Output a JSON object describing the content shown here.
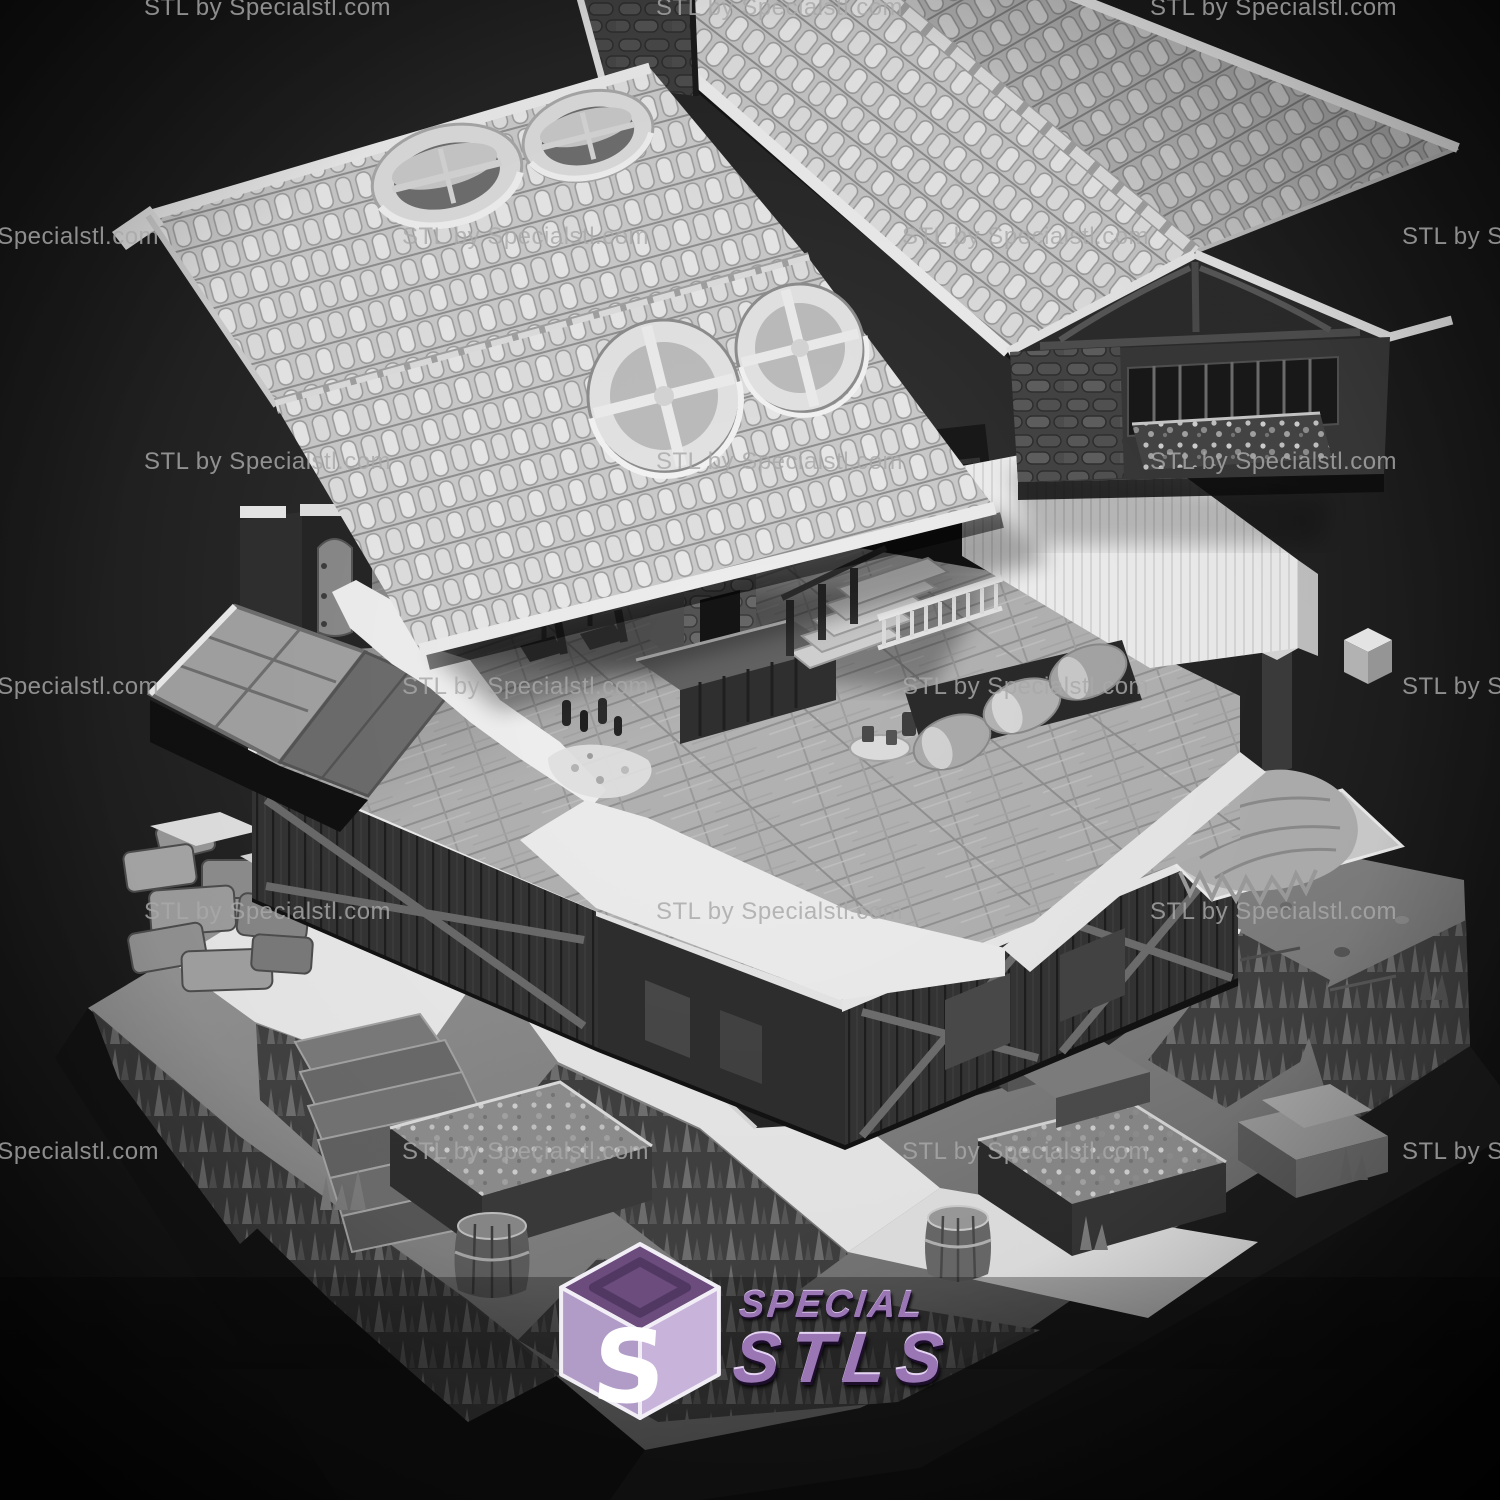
{
  "watermark": {
    "text": "STL by Specialstl.com"
  },
  "logo": {
    "monogram": "S",
    "brand_top": "SPECIAL",
    "brand_bottom": "STLS",
    "colors": {
      "cube_top": "#6b4c7d",
      "cube_left": "#b19bc7",
      "cube_right": "#c8b4da",
      "text_purple": "#9a76b5",
      "edge_white": "#f2eef6"
    }
  },
  "scene": {
    "subject": "Exploded-view monochrome 3D render of a two-story fantasy tavern terrain kit",
    "style": "grayscale clay render on dark vignette background",
    "layers": [
      {
        "name": "roof-assembly",
        "features": [
          "barrel-tile roof slopes",
          "two oval roof vents",
          "two round cross-pane windows",
          "half-timbered gable with window band and flower box",
          "stone dormer face"
        ]
      },
      {
        "name": "upper-floor",
        "features": [
          "wood plank floor",
          "table with chairs and bottles",
          "standing barrel",
          "stone chimney",
          "staircase with railing",
          "white cut wall tops",
          "barrel rack",
          "platter with mugs",
          "flat double door panel"
        ]
      },
      {
        "name": "ground-floor",
        "features": [
          "dark timber walls",
          "cross bracing",
          "small windows",
          "corner post",
          "hay pile on platform",
          "floating white block"
        ]
      },
      {
        "name": "terrain-base",
        "features": [
          "white stone paths",
          "curved stair steps",
          "ruined stone wall",
          "sunken cellar with counter",
          "planter boxes",
          "crates",
          "barrels",
          "grass tufts",
          "pebbles"
        ]
      }
    ]
  }
}
